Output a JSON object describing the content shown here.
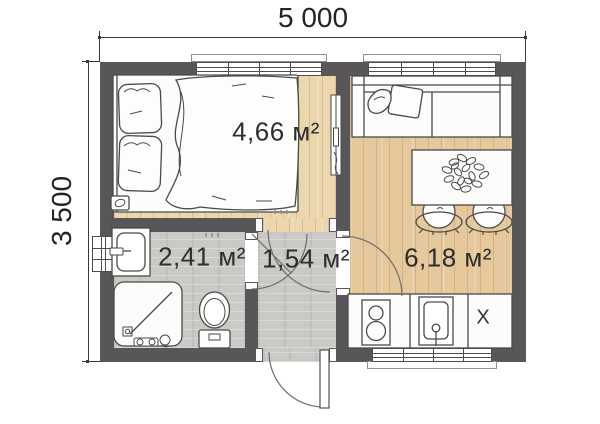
{
  "plan_title": "cabin-floor-plan",
  "dimensions": {
    "width_label": "5 000",
    "height_label": "3 500"
  },
  "rooms": [
    {
      "name": "bedroom",
      "area_label": "4,66 м²"
    },
    {
      "name": "bathroom",
      "area_label": "2,41 м²"
    },
    {
      "name": "hallway",
      "area_label": "1,54 м²"
    },
    {
      "name": "kitchen-living",
      "area_label": "6,18 м²"
    }
  ],
  "marks": {
    "x_mark": "X"
  },
  "furniture_icons": [
    "double-bed-icon",
    "pillow-icon",
    "sofa-icon",
    "dining-table-icon",
    "plant-icon",
    "chair-icon",
    "kitchen-counter-icon",
    "stove-icon",
    "kitchen-sink-icon",
    "bathroom-vanity-icon",
    "shower-icon",
    "toilet-icon",
    "entrance-door-icon"
  ],
  "colors": {
    "wall": "#585659",
    "wood_bedroom": "#ebd6ad",
    "wood_kitchen": "#e5c89c",
    "tile": "#cbc9c6",
    "outline": "#4a4a48",
    "background": "#ffffff",
    "text": "#2d2d2d"
  }
}
